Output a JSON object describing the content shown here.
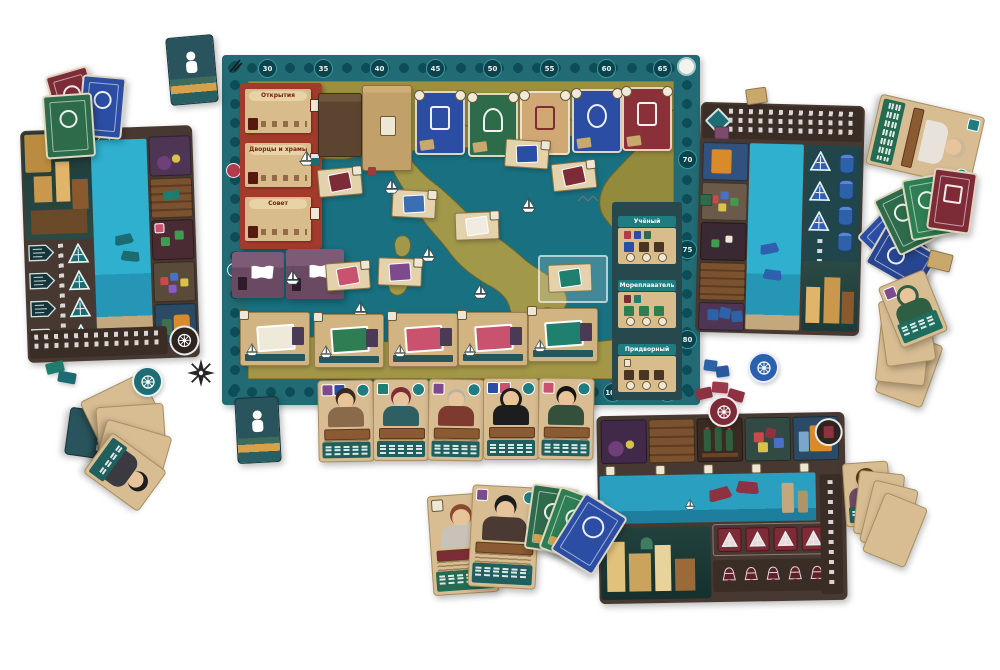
{
  "scene": {
    "description": "Фото настольной игры: центральное поле с картой Италии и шкалой очков, три планшета игроков (бирюзовый, синий, красный), карты персонажей, рыночные карты и жетоны",
    "background": "#ffffff"
  },
  "palette": {
    "board_frame_teal": "#226b74",
    "sea": "#187080",
    "land_olive": "#9a9040",
    "action_panel_red": "#a23b2b",
    "card_tan": "#d9bc8c",
    "card_green": "#2e6b4b",
    "card_blue": "#2b4da3",
    "card_maroon": "#7e2b38",
    "holder_purple": "#6a4a62",
    "player_teal": "#1d6b72",
    "player_blue": "#2f5fae",
    "player_red": "#8e3140",
    "water": "#2aa6c6",
    "board_wood_brown": "#473931"
  },
  "main_board": {
    "score_track": {
      "top_labels": [
        "30",
        "35",
        "40",
        "45",
        "50",
        "55",
        "60",
        "65"
      ],
      "right_labels": [
        "70",
        "75",
        "80"
      ],
      "bottom_labels": [
        "95",
        "100"
      ]
    },
    "action_panel": {
      "rows": [
        {
          "label": "Открытия"
        },
        {
          "label": "Дворцы и храмы"
        },
        {
          "label": "Совет"
        }
      ]
    },
    "role_panels": [
      {
        "label": "Учёный"
      },
      {
        "label": "Мореплаватель"
      },
      {
        "label": "Придворный"
      }
    ],
    "components": {
      "decks": 2,
      "market_cards": [
        "blue",
        "green",
        "tan",
        "blue",
        "maroon"
      ],
      "port_cards": 5,
      "map_tiles": 8,
      "white_ships": 7,
      "card_holders_purple": 2,
      "character_cards_row": 5,
      "reference_cards_teal": 2
    }
  },
  "player_boards": {
    "left": {
      "color": "teal",
      "ship_tokens": 4,
      "resource_slots": 5
    },
    "right": {
      "color": "blue",
      "ship_tokens": 3,
      "bottle_tokens": 4,
      "resource_slots": 5
    },
    "bottom": {
      "color": "red",
      "sail_tiles": 4,
      "bell_tokens": 5,
      "resource_slots": 5
    }
  },
  "loose_cards": {
    "top_left_fan": [
      "maroon",
      "blue",
      "green"
    ],
    "top_right_character": 1,
    "right_fan": [
      "green",
      "green",
      "maroon",
      "blue",
      "blue"
    ],
    "right_character_fan": 4,
    "bottom_left_character_fan": 5,
    "bottom_center_characters": 2,
    "bottom_center_fan": [
      "green",
      "green",
      "blue"
    ],
    "bottom_right_character_fan": 4
  },
  "tokens": {
    "wheel_discs": [
      "teal",
      "blue",
      "maroon"
    ],
    "teal_pieces": 2,
    "blue_cubes": 2,
    "maroon_pieces": 3
  }
}
